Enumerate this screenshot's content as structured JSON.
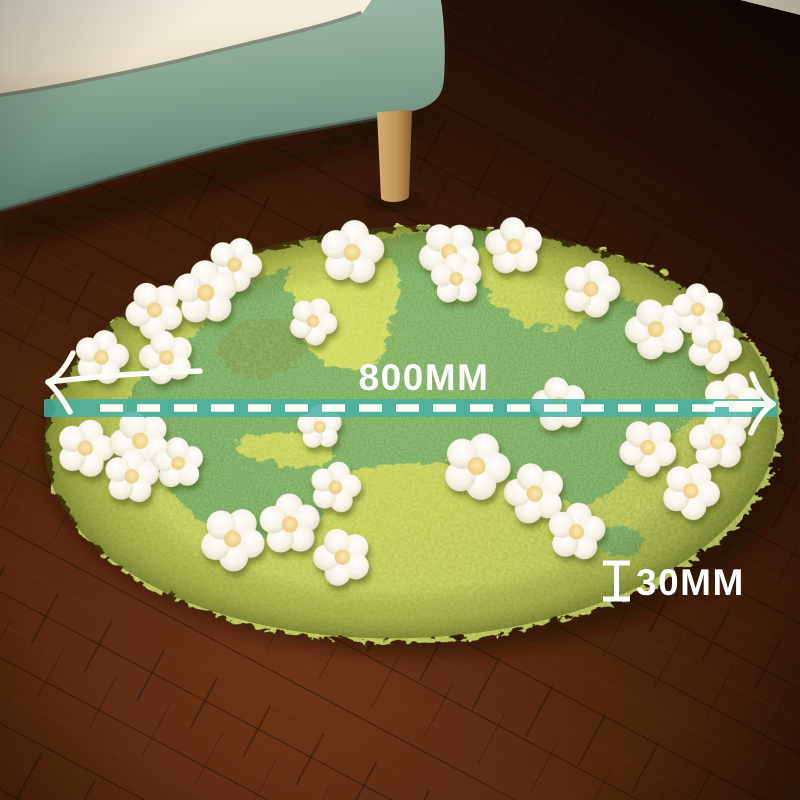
{
  "annotations": {
    "diameter_label": "800MM",
    "thickness_label": "30MM"
  },
  "icons": {
    "diameter_left_arrow": "arrow-left-icon",
    "diameter_right_arrow": "arrow-right-icon",
    "thickness_icon": "height-indicator-icon",
    "measure_line": "dashed-measure-line"
  },
  "colors": {
    "dimension_band_teal": "#46b0a3",
    "measure_dash_white": "#fbfcf4",
    "annotation_text_white": "#ffffff",
    "rug_moss_green": "#b9c440",
    "rug_woven_green": "#5b9440",
    "flower_petal_white": "#f6f2e6",
    "flower_center_yellow": "#efd78c",
    "floor_wood_brown": "#4e2410",
    "sofa_fabric_sage": "#8aa795",
    "sofa_cushion_cream": "#f0eadb",
    "sofa_leg_wood": "#c3965a"
  }
}
